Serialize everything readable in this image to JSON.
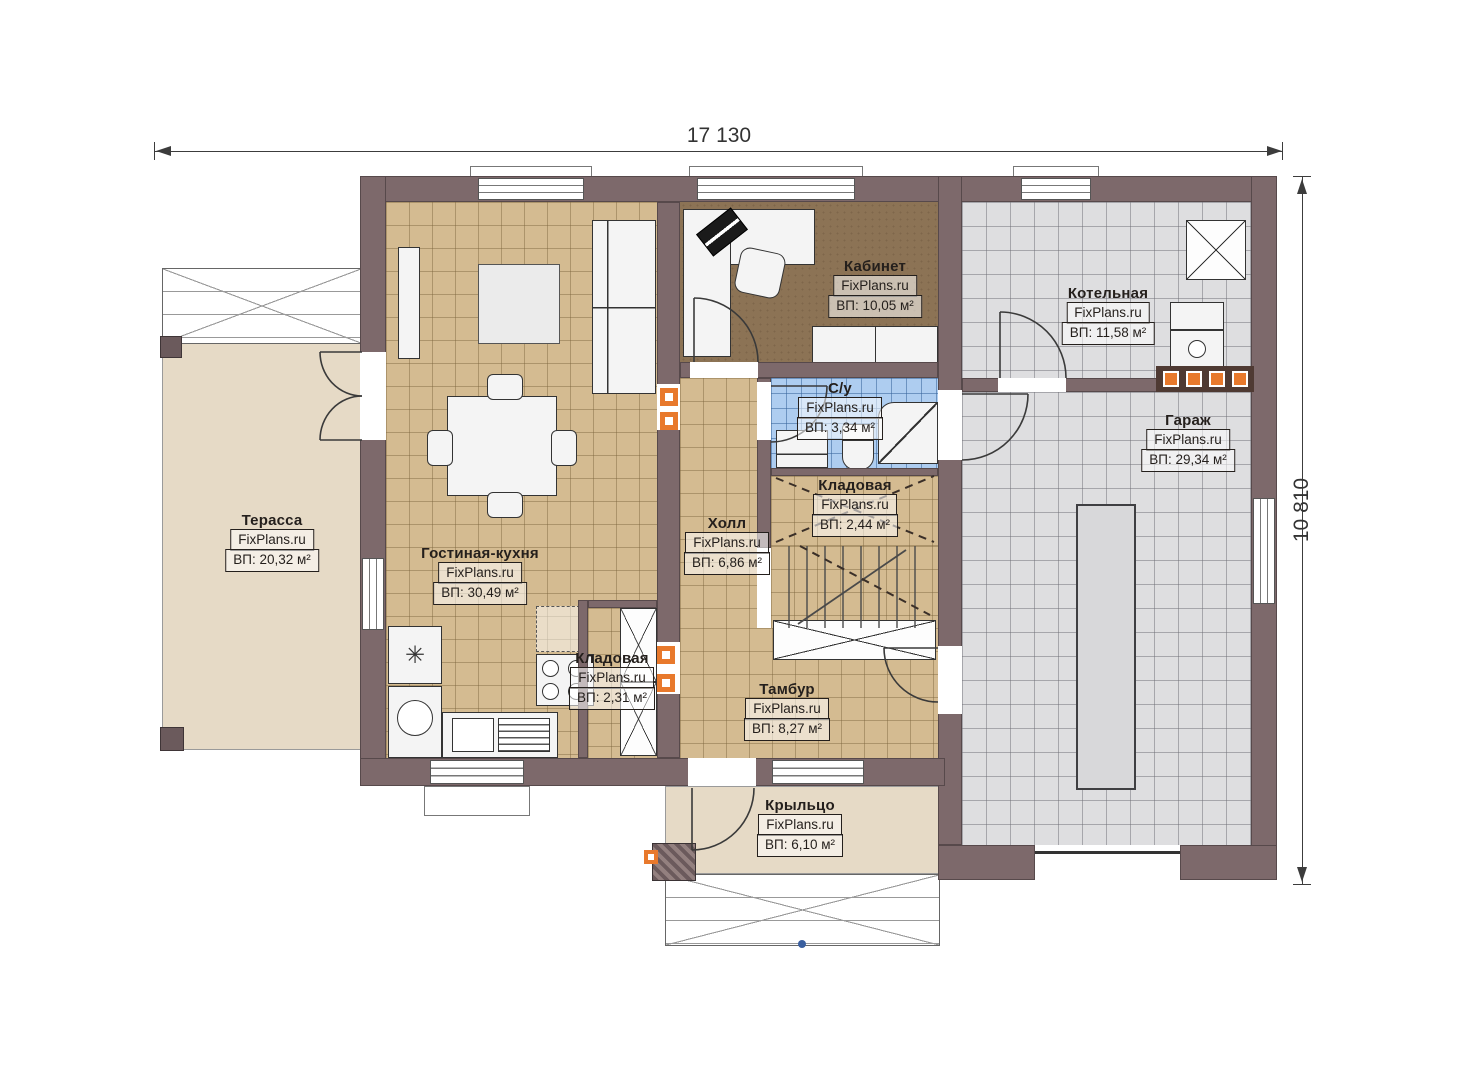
{
  "plan": {
    "watermark": "FixPlans.ru",
    "dimensions": {
      "width": "17 130",
      "height": "10 810"
    },
    "rooms": [
      {
        "name": "Терасса",
        "area": "ВП: 20,32 м²"
      },
      {
        "name": "Гостиная-кухня",
        "area": "ВП: 30,49 м²"
      },
      {
        "name": "Кабинет",
        "area": "ВП: 10,05 м²"
      },
      {
        "name": "Котельная",
        "area": "ВП: 11,58 м²"
      },
      {
        "name": "Гараж",
        "area": "ВП: 29,34 м²"
      },
      {
        "name": "С/у",
        "area": "ВП: 3,34 м²"
      },
      {
        "name": "Кладовая",
        "area": "ВП: 2,44 м²"
      },
      {
        "name": "Холл",
        "area": "ВП: 6,86 м²"
      },
      {
        "name": "Кладовая",
        "area": "ВП: 2,31 м²"
      },
      {
        "name": "Тамбур",
        "area": "ВП: 8,27 м²"
      },
      {
        "name": "Крыльцо",
        "area": "ВП: 6,10 м²"
      }
    ],
    "icons": {
      "fridge_snowflake": "✳"
    },
    "colors": {
      "wall": "#7d696b",
      "floor_tan": "#d4bb91",
      "floor_gray": "#dedee0",
      "floor_blue": "#aecdf0",
      "floor_brown": "#8c7355",
      "floor_beige": "#e6dac6",
      "accent_orange": "#e8792c"
    }
  }
}
